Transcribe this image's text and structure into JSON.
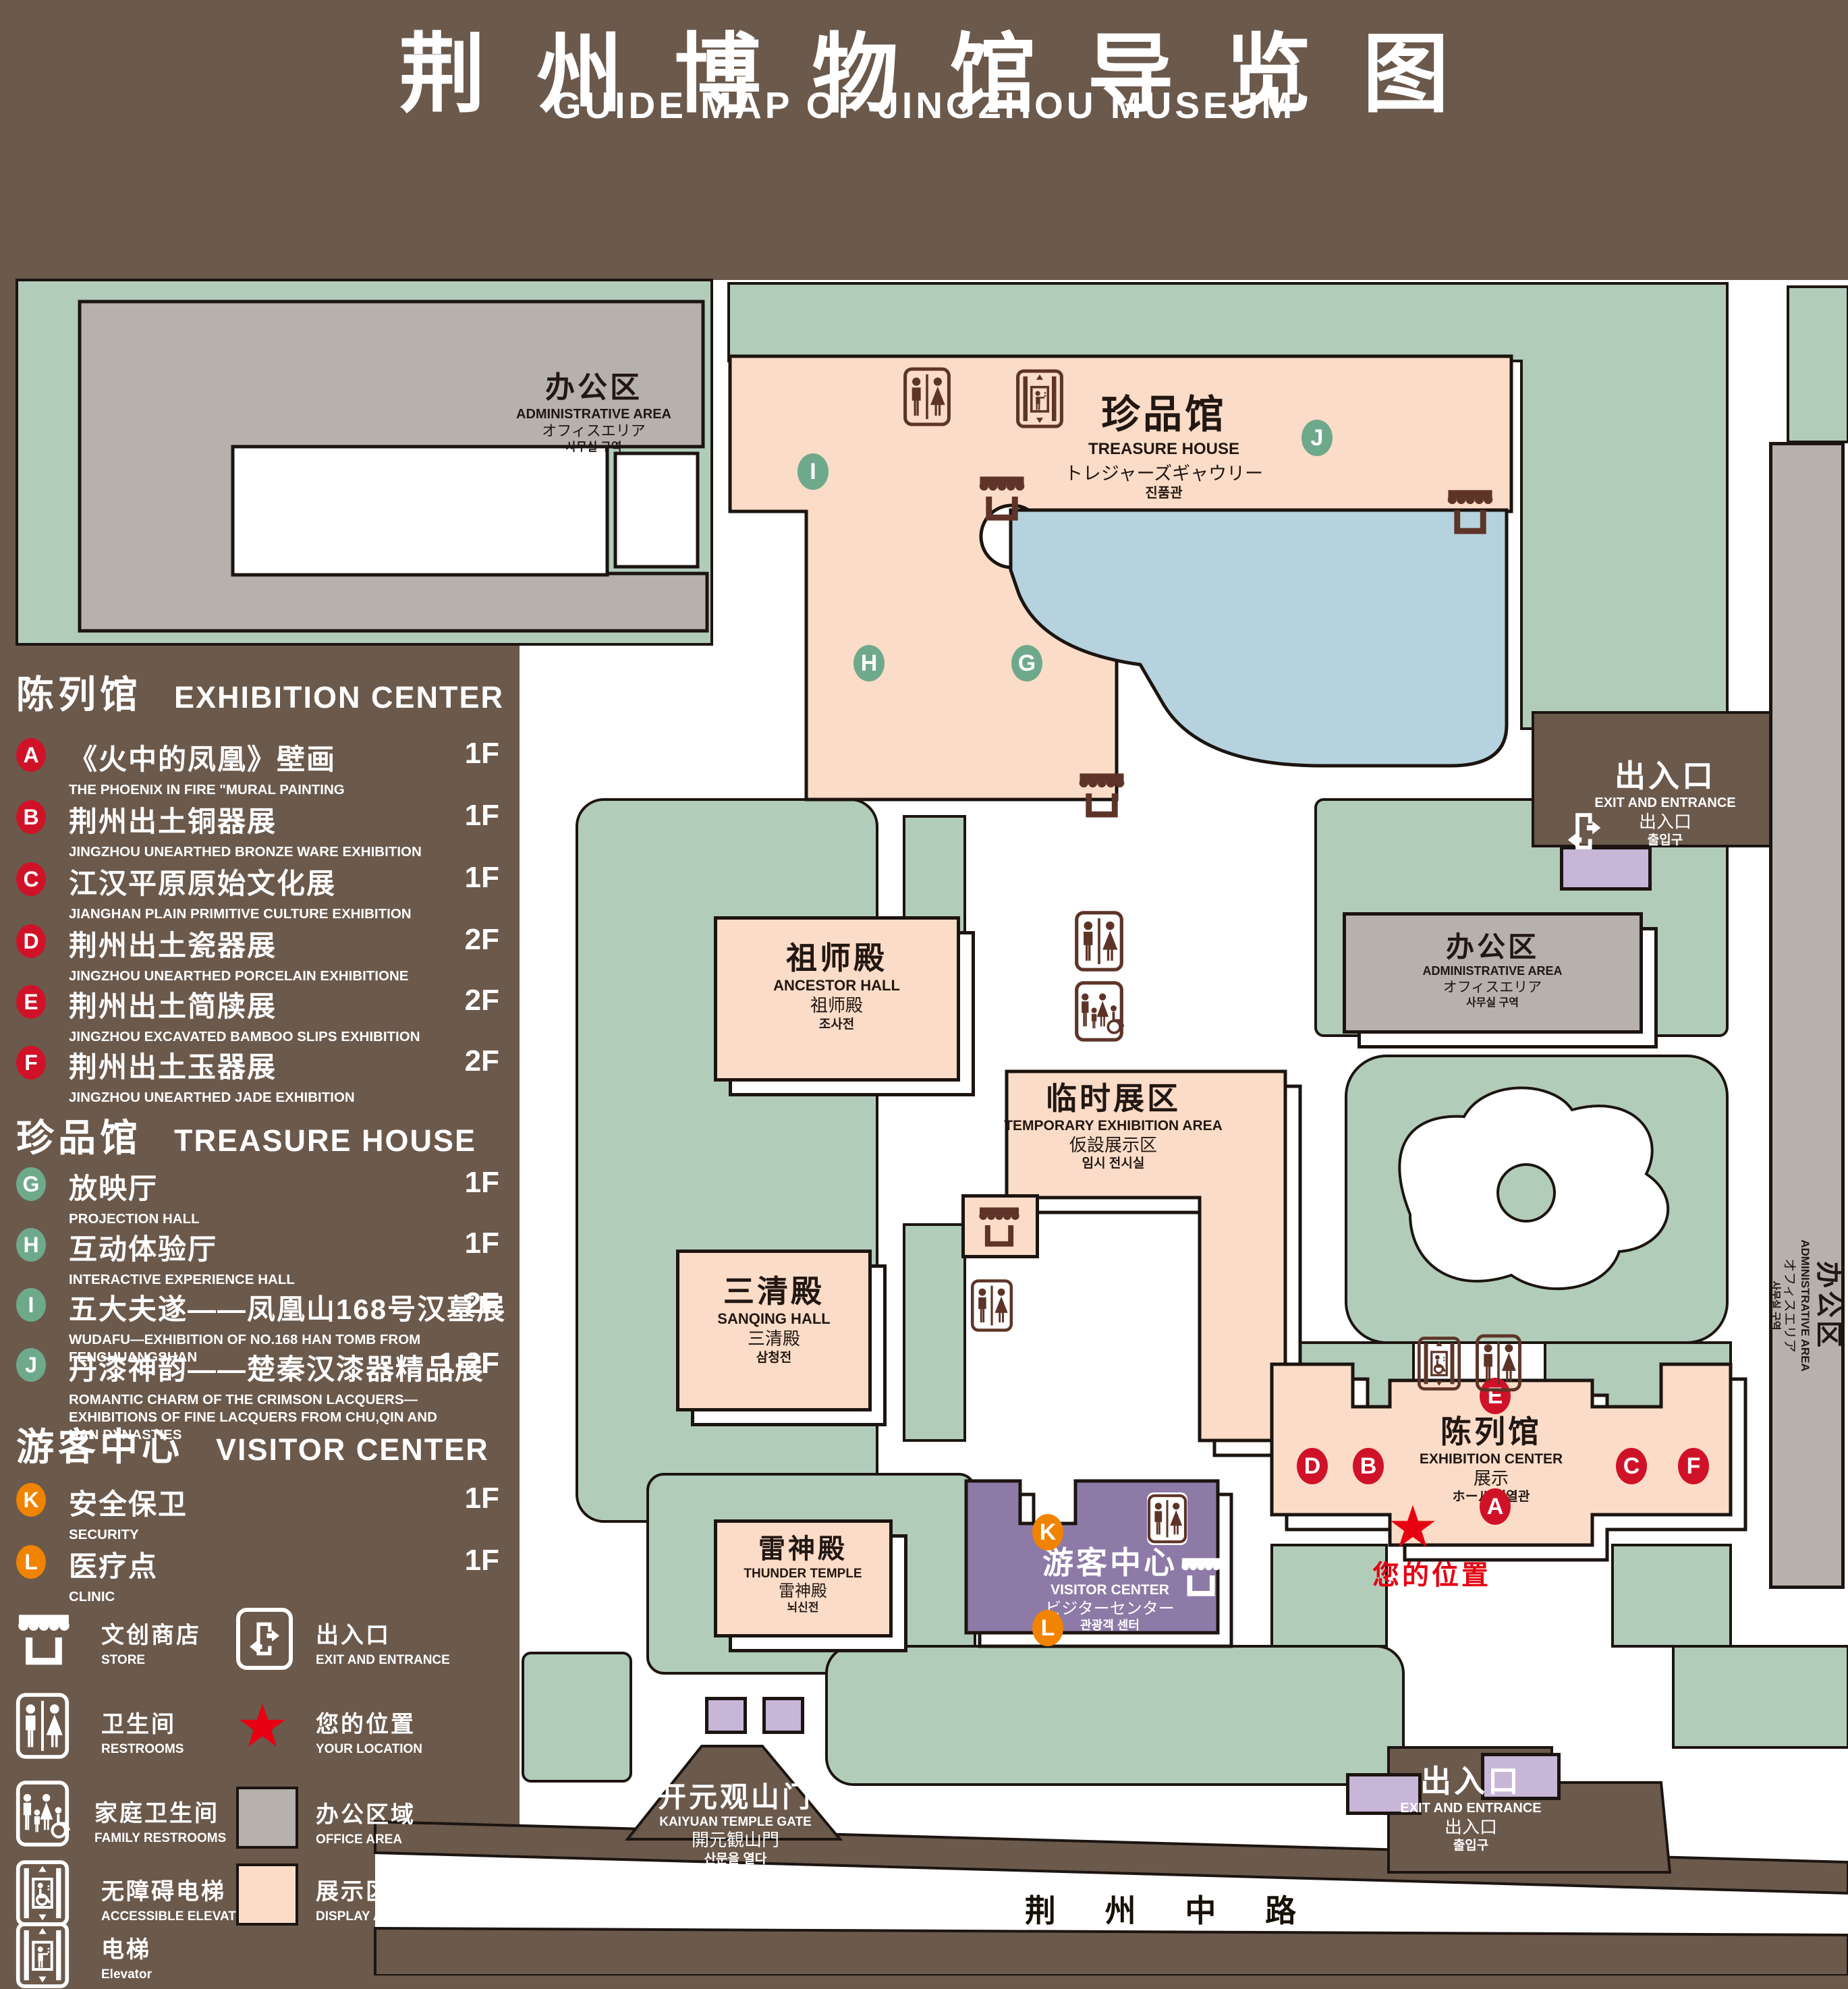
{
  "title": {
    "zh": "荆州博物馆导览图",
    "en": "GUIDE MAP OF JINGZHOU MUSEUM"
  },
  "sections": [
    {
      "zh": "陈列馆",
      "en": "EXHIBITION CENTER",
      "items": [
        {
          "letter": "A",
          "zh": "《火中的凤凰》壁画",
          "en": "THE PHOENIX IN FIRE \"MURAL PAINTING",
          "floor": "1F"
        },
        {
          "letter": "B",
          "zh": "荆州出土铜器展",
          "en": "JINGZHOU UNEARTHED BRONZE WARE EXHIBITION",
          "floor": "1F"
        },
        {
          "letter": "C",
          "zh": "江汉平原原始文化展",
          "en": "JIANGHAN PLAIN PRIMITIVE CULTURE EXHIBITION",
          "floor": "1F"
        },
        {
          "letter": "D",
          "zh": "荆州出土瓷器展",
          "en": "JINGZHOU UNEARTHED PORCELAIN EXHIBITIONE",
          "floor": "2F"
        },
        {
          "letter": "E",
          "zh": "荆州出土简牍展",
          "en": "JINGZHOU EXCAVATED BAMBOO SLIPS EXHIBITION",
          "floor": "2F"
        },
        {
          "letter": "F",
          "zh": "荆州出土玉器展",
          "en": "JINGZHOU UNEARTHED JADE EXHIBITION",
          "floor": "2F"
        }
      ]
    },
    {
      "zh": "珍品馆",
      "en": "TREASURE HOUSE",
      "items": [
        {
          "letter": "G",
          "zh": "放映厅",
          "en": "PROJECTION HALL",
          "floor": "1F"
        },
        {
          "letter": "H",
          "zh": "互动体验厅",
          "en": "INTERACTIVE EXPERIENCE HALL",
          "floor": "1F"
        },
        {
          "letter": "I",
          "zh": "五大夫遂——凤凰山168号汉墓展",
          "en": "WUDAFU—EXHIBITION OF NO.168 HAN TOMB FROM FENGHUANGSHAN",
          "floor": "2F"
        },
        {
          "letter": "J",
          "zh": "丹漆神韵——楚秦汉漆器精品展",
          "en": "ROMANTIC CHARM OF THE CRIMSON LACQUERS—EXHIBITIONS OF FINE LACQUERS FROM CHU,QIN AND HAN DYNASTIES",
          "floor": "1-2F"
        }
      ]
    },
    {
      "zh": "游客中心",
      "en": "VISITOR CENTER",
      "items": [
        {
          "letter": "K",
          "zh": "安全保卫",
          "en": "SECURITY",
          "floor": "1F"
        },
        {
          "letter": "L",
          "zh": "医疗点",
          "en": "CLINIC",
          "floor": "1F"
        }
      ]
    }
  ],
  "legend": [
    {
      "icon": "store-icon",
      "zh": "文创商店",
      "en": "STORE"
    },
    {
      "icon": "exit-icon",
      "zh": "出入口",
      "en": "EXIT AND ENTRANCE"
    },
    {
      "icon": "restroom-icon",
      "zh": "卫生间",
      "en": "RESTROOMS"
    },
    {
      "icon": "location-star-icon",
      "zh": "您的位置",
      "en": "YOUR LOCATION"
    },
    {
      "icon": "family-restroom-icon",
      "zh": "家庭卫生间",
      "en": "FAMILY RESTROOMS"
    },
    {
      "icon": "office-area-swatch",
      "zh": "办公区域",
      "en": "OFFICE AREA"
    },
    {
      "icon": "accessible-elevator-icon",
      "zh": "无障碍电梯",
      "en": "ACCESSIBLE ELEVATOR"
    },
    {
      "icon": "display-area-swatch",
      "zh": "展示区域",
      "en": "DISPLAY AREA"
    },
    {
      "icon": "elevator-icon",
      "zh": "电梯",
      "en": "Elevator"
    }
  ],
  "map": {
    "admin": {
      "zh": "办公区",
      "en": "ADMINISTRATIVE AREA",
      "jp": "オフィスエリア",
      "kr": "사무실 구역"
    },
    "treasure": {
      "zh": "珍品馆",
      "en": "TREASURE HOUSE",
      "jp": "トレジャーズギャウリー",
      "kr": "진품관"
    },
    "ancestor": {
      "zh": "祖师殿",
      "en": "ANCESTOR HALL",
      "jp": "祖师殿",
      "kr": "조사전"
    },
    "temporary": {
      "zh": "临时展区",
      "en": "TEMPORARY EXHIBITION AREA",
      "jp": "仮設展示区",
      "kr": "임시 전시실"
    },
    "sanqing": {
      "zh": "三清殿",
      "en": "SANQING HALL",
      "jp": "三清殿",
      "kr": "삼청전"
    },
    "thunder": {
      "zh": "雷神殿",
      "en": "THUNDER TEMPLE",
      "jp": "雷神殿",
      "kr": "뇌신전"
    },
    "visitor": {
      "zh": "游客中心",
      "en": "VISITOR CENTER",
      "jp": "ビジターセンター",
      "kr": "관광객 센터"
    },
    "exhibition": {
      "zh": "陈列馆",
      "en": "EXHIBITION CENTER",
      "jp": "展示",
      "kr": "ホール 진열관"
    },
    "exit": {
      "zh": "出入口",
      "en": "EXIT AND ENTRANCE",
      "jp": "出入口",
      "kr": "출입구"
    },
    "gate": {
      "zh": "开元观山门",
      "en": "KAIYUAN TEMPLE GATE",
      "jp": "開元観山門",
      "kr": "산문을 열다"
    },
    "road": "荆 州 中 路",
    "your_location": "您的位置"
  },
  "colors": {
    "background": "#6b594c",
    "lawn": "#b2ccba",
    "display_area": "#fadcc8",
    "office_area": "#b6b1ac",
    "pond": "#b5d2de",
    "visitor_center": "#8d7aa7",
    "gate_building": "#c7b6d7",
    "badge_red": "#d01228",
    "badge_green": "#6fa98c",
    "badge_orange": "#f08300",
    "icon_brown": "#5e3428",
    "star_red": "#e60012",
    "line": "#1c1410"
  }
}
